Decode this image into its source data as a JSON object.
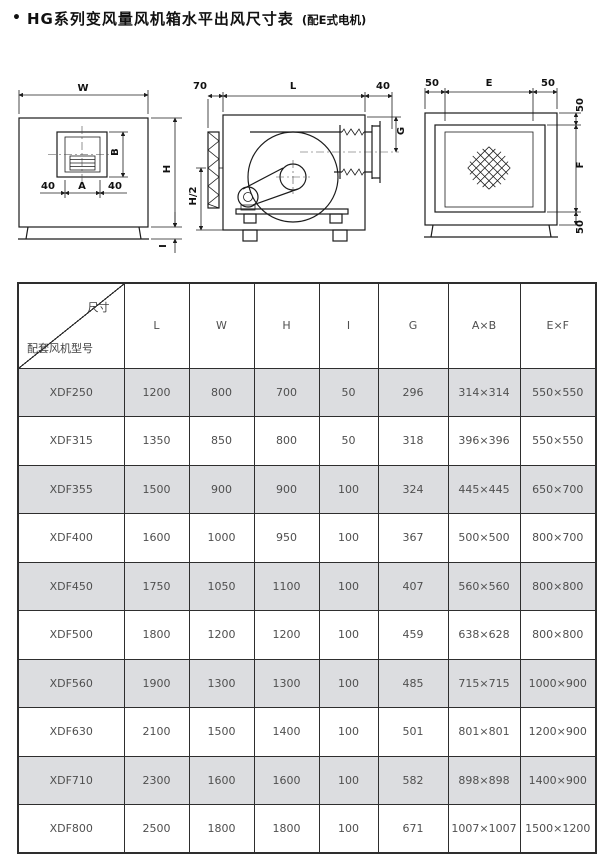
{
  "title": {
    "bullet": "•",
    "text": "HG系列变风量风机箱水平出风尺寸表",
    "suffix": "(配E式电机)"
  },
  "drawings": {
    "front": {
      "w": "W",
      "h": "H",
      "b": "B",
      "a": "A",
      "forty_left": "40",
      "forty_right": "40",
      "i": "I"
    },
    "side": {
      "seventy": "70",
      "l": "L",
      "forty": "40",
      "g": "G",
      "half_h": "H/2"
    },
    "rear": {
      "fifty_top_left": "50",
      "e": "E",
      "fifty_top_right": "50",
      "fifty_right_top": "50",
      "f": "F",
      "fifty_right_bottom": "50"
    }
  },
  "table": {
    "corner": {
      "top": "尺寸",
      "bottom": "配套风机型号"
    },
    "columns": [
      "L",
      "W",
      "H",
      "I",
      "G",
      "A×B",
      "E×F"
    ],
    "rows": [
      {
        "model": "XDF250",
        "values": [
          "1200",
          "800",
          "700",
          "50",
          "296",
          "314×314",
          "550×550"
        ]
      },
      {
        "model": "XDF315",
        "values": [
          "1350",
          "850",
          "800",
          "50",
          "318",
          "396×396",
          "550×550"
        ]
      },
      {
        "model": "XDF355",
        "values": [
          "1500",
          "900",
          "900",
          "100",
          "324",
          "445×445",
          "650×700"
        ]
      },
      {
        "model": "XDF400",
        "values": [
          "1600",
          "1000",
          "950",
          "100",
          "367",
          "500×500",
          "800×700"
        ]
      },
      {
        "model": "XDF450",
        "values": [
          "1750",
          "1050",
          "1100",
          "100",
          "407",
          "560×560",
          "800×800"
        ]
      },
      {
        "model": "XDF500",
        "values": [
          "1800",
          "1200",
          "1200",
          "100",
          "459",
          "638×628",
          "800×800"
        ]
      },
      {
        "model": "XDF560",
        "values": [
          "1900",
          "1300",
          "1300",
          "100",
          "485",
          "715×715",
          "1000×900"
        ]
      },
      {
        "model": "XDF630",
        "values": [
          "2100",
          "1500",
          "1400",
          "100",
          "501",
          "801×801",
          "1200×900"
        ]
      },
      {
        "model": "XDF710",
        "values": [
          "2300",
          "1600",
          "1600",
          "100",
          "582",
          "898×898",
          "1400×900"
        ]
      },
      {
        "model": "XDF800",
        "values": [
          "2500",
          "1800",
          "1800",
          "100",
          "671",
          "1007×1007",
          "1500×1200"
        ]
      }
    ]
  },
  "colors": {
    "row_shaded": "#dcdde0",
    "table_border": "#2e2e2e",
    "line_art": "#1c1c1c",
    "text": "#4f4f4f"
  }
}
